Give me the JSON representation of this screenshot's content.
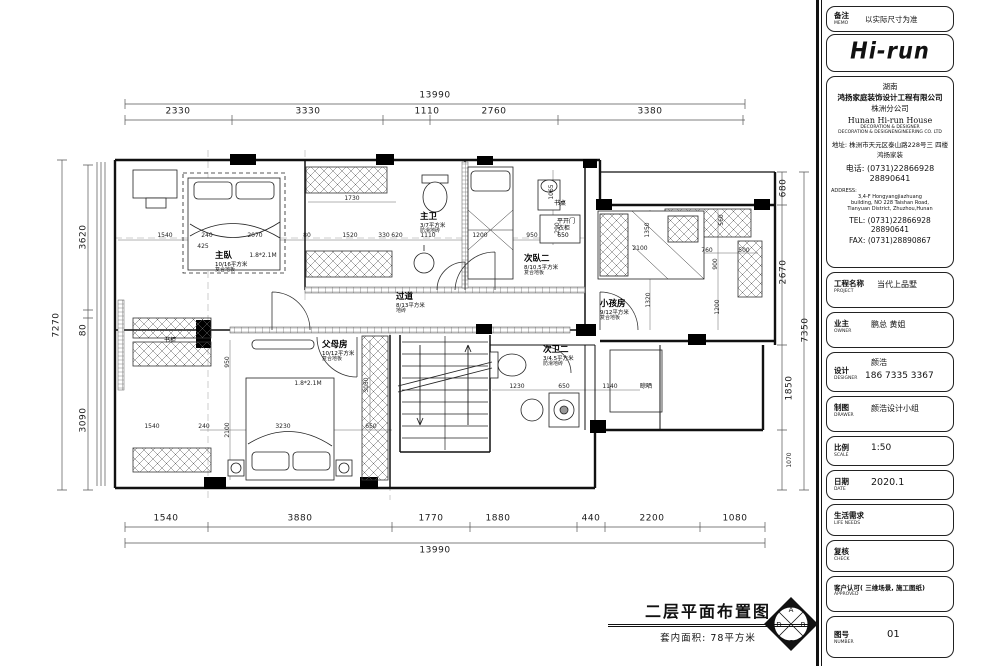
{
  "plan": {
    "title": "二层平面布置图",
    "subtitle": "套内面积: 78平方米",
    "compass": {
      "n": "A",
      "w": "D",
      "e": "B",
      "s": "C"
    },
    "rooms": {
      "master_bedroom": {
        "name": "主臥",
        "area": "10/16平方米",
        "floor": "复合地板"
      },
      "master_bath": {
        "name": "主卫",
        "area": "3/7平方米",
        "floor": "防滑地砖"
      },
      "corridor": {
        "name": "过道",
        "area": "8/13平方米",
        "floor": "地砖"
      },
      "second_bedroom": {
        "name": "次臥二",
        "area": "8/10.5平方米",
        "floor": "复合地板"
      },
      "kids_room": {
        "name": "小孩房",
        "area": "9/12平方米",
        "floor": "复合地板"
      },
      "parents_room": {
        "name": "父母房",
        "area": "10/12平方米",
        "floor": "复合地板"
      },
      "second_bath": {
        "name": "次卫二",
        "area": "3/4.5平方米",
        "floor": "防滑地砖"
      }
    },
    "small_labels": [
      {
        "t": "书桌",
        "x": 560,
        "y": 204
      },
      {
        "t": "平开门",
        "x": 566,
        "y": 222
      },
      {
        "t": "衣柜",
        "x": 564,
        "y": 229
      },
      {
        "t": "650",
        "x": 563,
        "y": 236
      },
      {
        "t": "书柜",
        "x": 170,
        "y": 341
      },
      {
        "t": "晾晒",
        "x": 646,
        "y": 387
      }
    ],
    "dim_labels": [
      {
        "t": "13990",
        "x": 435,
        "y": 96,
        "big": 1
      },
      {
        "t": "2330",
        "x": 178,
        "y": 112,
        "big": 1
      },
      {
        "t": "3330",
        "x": 308,
        "y": 112,
        "big": 1
      },
      {
        "t": "1110",
        "x": 427,
        "y": 112,
        "big": 1
      },
      {
        "t": "2760",
        "x": 494,
        "y": 112,
        "big": 1
      },
      {
        "t": "3380",
        "x": 650,
        "y": 112,
        "big": 1
      },
      {
        "t": "13990",
        "x": 435,
        "y": 551,
        "big": 1
      },
      {
        "t": "1540",
        "x": 166,
        "y": 519,
        "big": 1
      },
      {
        "t": "3880",
        "x": 300,
        "y": 519,
        "big": 1
      },
      {
        "t": "1770",
        "x": 431,
        "y": 519,
        "big": 1
      },
      {
        "t": "1880",
        "x": 498,
        "y": 519,
        "big": 1
      },
      {
        "t": "440",
        "x": 591,
        "y": 519,
        "big": 1
      },
      {
        "t": "2200",
        "x": 652,
        "y": 519,
        "big": 1
      },
      {
        "t": "1080",
        "x": 735,
        "y": 519,
        "big": 1
      },
      {
        "t": "7270",
        "x": 57,
        "y": 325,
        "r": 1,
        "big": 1
      },
      {
        "t": "3620",
        "x": 84,
        "y": 237,
        "r": 1,
        "big": 1
      },
      {
        "t": "80",
        "x": 84,
        "y": 330,
        "r": 1,
        "big": 1
      },
      {
        "t": "3090",
        "x": 84,
        "y": 420,
        "r": 1,
        "big": 1
      },
      {
        "t": "7350",
        "x": 806,
        "y": 330,
        "r": 1,
        "big": 1
      },
      {
        "t": "680",
        "x": 784,
        "y": 188,
        "r": 1,
        "big": 1
      },
      {
        "t": "2670",
        "x": 784,
        "y": 272,
        "r": 1,
        "big": 1
      },
      {
        "t": "1850",
        "x": 790,
        "y": 388,
        "r": 1,
        "big": 1
      },
      {
        "t": "1070",
        "x": 790,
        "y": 460,
        "r": 1
      },
      {
        "t": "1730",
        "x": 352,
        "y": 199
      },
      {
        "t": "1540",
        "x": 165,
        "y": 236
      },
      {
        "t": "240",
        "x": 207,
        "y": 236
      },
      {
        "t": "2070",
        "x": 255,
        "y": 236
      },
      {
        "t": "80",
        "x": 307,
        "y": 236
      },
      {
        "t": "1520",
        "x": 350,
        "y": 236
      },
      {
        "t": "330",
        "x": 384,
        "y": 236
      },
      {
        "t": "620",
        "x": 397,
        "y": 236
      },
      {
        "t": "1110",
        "x": 428,
        "y": 236
      },
      {
        "t": "1200",
        "x": 480,
        "y": 236
      },
      {
        "t": "950",
        "x": 532,
        "y": 236
      },
      {
        "t": "425",
        "x": 203,
        "y": 247
      },
      {
        "t": "290",
        "x": 558,
        "y": 228,
        "r": 1
      },
      {
        "t": "1065",
        "x": 552,
        "y": 192,
        "r": 1
      },
      {
        "t": "2100",
        "x": 640,
        "y": 249
      },
      {
        "t": "1350",
        "x": 648,
        "y": 230,
        "r": 1
      },
      {
        "t": "760",
        "x": 707,
        "y": 251
      },
      {
        "t": "900",
        "x": 716,
        "y": 264,
        "r": 1
      },
      {
        "t": "500",
        "x": 744,
        "y": 251
      },
      {
        "t": "560",
        "x": 722,
        "y": 220,
        "r": 1
      },
      {
        "t": "1320",
        "x": 649,
        "y": 300,
        "r": 1
      },
      {
        "t": "1200",
        "x": 718,
        "y": 307,
        "r": 1
      },
      {
        "t": "950",
        "x": 228,
        "y": 362,
        "r": 1
      },
      {
        "t": "2100",
        "x": 228,
        "y": 430,
        "r": 1
      },
      {
        "t": "3230",
        "x": 283,
        "y": 427
      },
      {
        "t": "650",
        "x": 371,
        "y": 427
      },
      {
        "t": "3050",
        "x": 367,
        "y": 385,
        "r": 1
      },
      {
        "t": "240",
        "x": 204,
        "y": 427
      },
      {
        "t": "1540",
        "x": 152,
        "y": 427
      },
      {
        "t": "1230",
        "x": 517,
        "y": 387
      },
      {
        "t": "650",
        "x": 564,
        "y": 387
      },
      {
        "t": "1140",
        "x": 610,
        "y": 387
      },
      {
        "t": "1.8*2.1M",
        "x": 263,
        "y": 256
      },
      {
        "t": "1.8*2.1M",
        "x": 308,
        "y": 384
      }
    ]
  },
  "title_block": {
    "memo": {
      "label": "备注",
      "label_en": "MEMO",
      "value": "以实际尺寸为准"
    },
    "logo_text": "Hi-run",
    "company": {
      "region": "湖南",
      "name": "鸿扬家庭装饰设计工程有限公司",
      "branch": "株洲分公司",
      "name_en": "Hunan  Hi-run  House",
      "sub_en1": "DECORATION & DESIGNER",
      "sub_en2": "DECORATION & DESIGNENGINEERING CO. LTD",
      "addr_label": "地址:",
      "addr1": "株洲市天元区泰山路228号三 四楼",
      "addr2": "鸿扬家装",
      "tel_label": "电话:",
      "tel1": "(0731)22866928",
      "tel2": "28890641",
      "address_en_label": "ADDRESS:",
      "address_en1": "3,4-F Hongyangjiazhuang",
      "address_en2": "building, NO 228 Taishan Road,",
      "address_en3": "Tianyuan District, Zhuzhou,Hunan",
      "tel_en_label": "TEL:",
      "tel_en1": "(0731)22866928",
      "tel_en2": "28890641",
      "fax_label": "FAX:",
      "fax": "(0731)28890867"
    },
    "project": {
      "label": "工程名称",
      "label_en": "PROJECT",
      "value": "当代上品墅"
    },
    "owner": {
      "label": "业主",
      "label_en": "OWNER",
      "value": "鹏总  黄姐"
    },
    "designer": {
      "label": "设计",
      "label_en": "DESIGNER",
      "name": "颜浩",
      "phone": "186  7335  3367"
    },
    "drawer": {
      "label": "制图",
      "label_en": "DRAWER",
      "value": "颜浩设计小组"
    },
    "scale": {
      "label": "比例",
      "label_en": "SCALE",
      "value": "1:50"
    },
    "date": {
      "label": "日期",
      "label_en": "DATE",
      "value": "2020.1"
    },
    "life_needs": {
      "label": "生活需求",
      "label_en": "LIFE  NEEDS"
    },
    "check": {
      "label": "复核",
      "label_en": "CHECK"
    },
    "approved": {
      "label": "客户认可( 三维场景, 施工图纸)",
      "label_en": "APPROVED"
    },
    "number": {
      "label": "图号",
      "label_en": "NUMBER",
      "value": "01"
    }
  }
}
